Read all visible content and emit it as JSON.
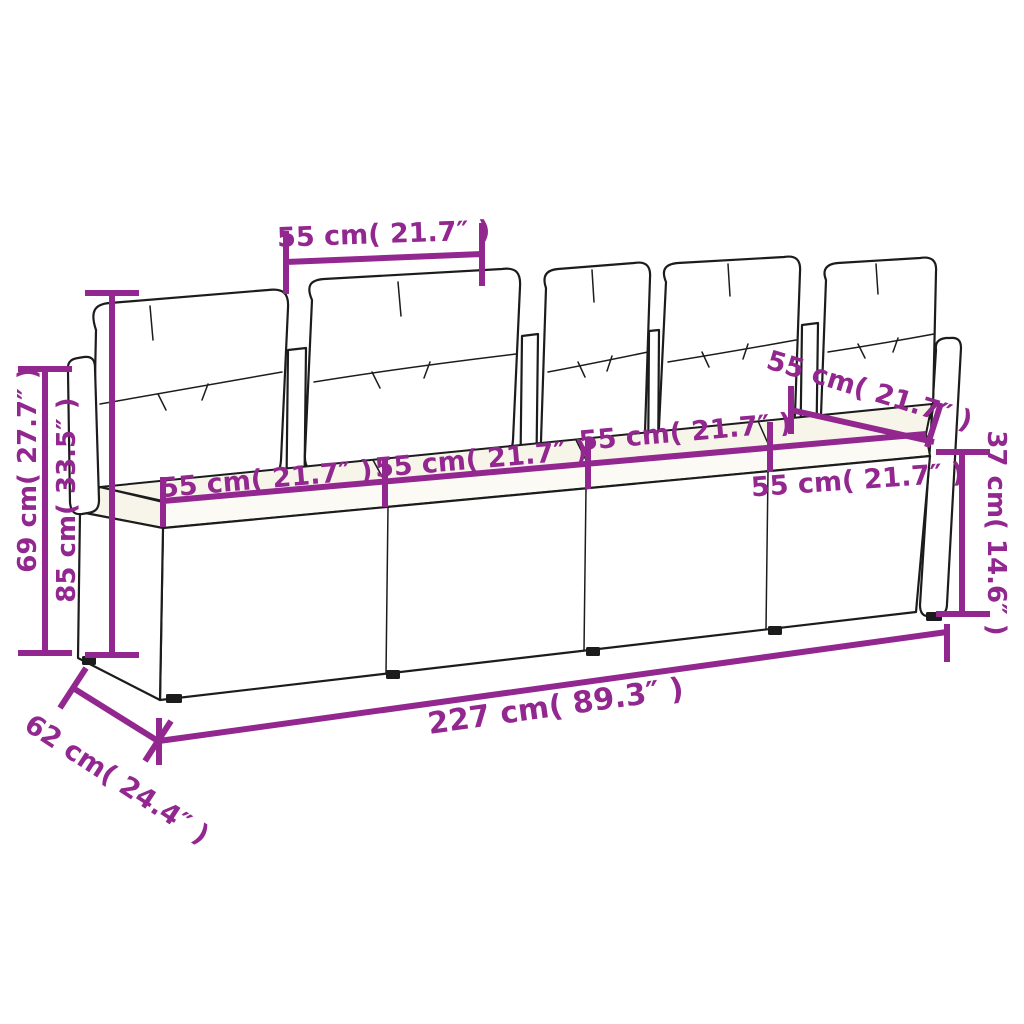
{
  "accent_color": "#92278F",
  "figure": {
    "subject": "4-seater poly rattan garden sofa with seat and back cushions",
    "style": "black line-art sketch with magenta dimension annotations on white background"
  },
  "dimensions": {
    "back_cushion_width": {
      "label": "55 cm( 21.7″ )"
    },
    "back_height": {
      "label": "69 cm( 27.7″ )"
    },
    "total_height": {
      "label": "85 cm( 33.5″ )"
    },
    "seat_width_1": {
      "label": "55 cm( 21.7″ )"
    },
    "seat_width_2": {
      "label": "55 cm( 21.7″ )"
    },
    "seat_width_3": {
      "label": "55 cm( 21.7″ )"
    },
    "seat_width_4": {
      "label": "55 cm( 21.7″ )"
    },
    "arm_top_width": {
      "label": "55 cm( 21.7″ )"
    },
    "seat_height": {
      "label": "37 cm( 14.6″ )"
    },
    "total_width": {
      "label": "227 cm( 89.3″ )"
    },
    "seat_depth": {
      "label": "62 cm( 24.4″ )"
    }
  }
}
